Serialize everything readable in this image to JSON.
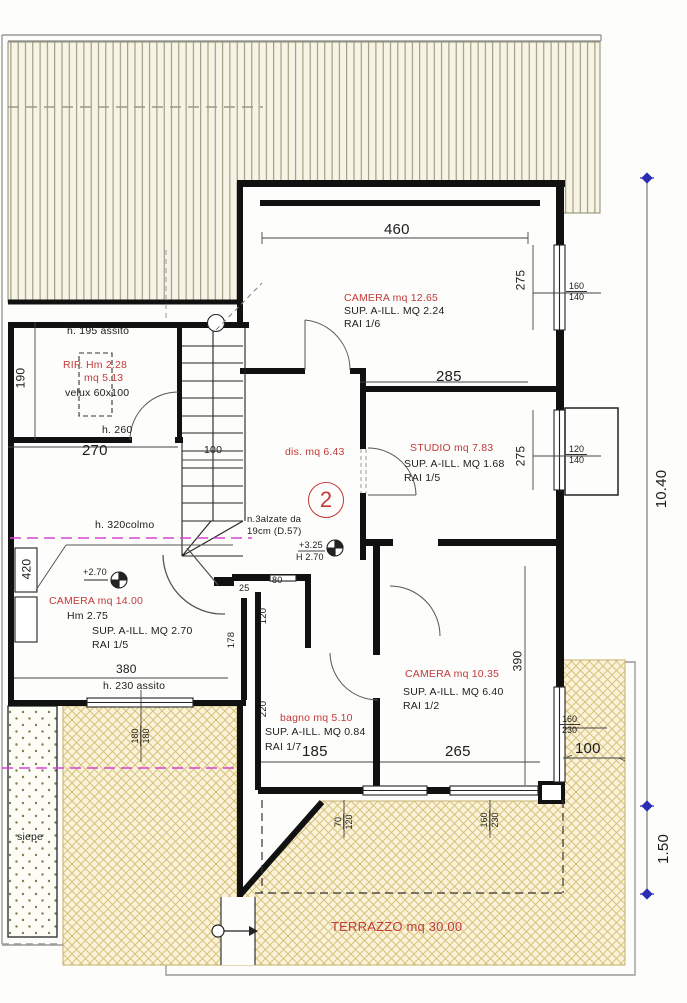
{
  "sheet": {
    "floor_badge": "2"
  },
  "colors": {
    "accent_red": "#c23a3a",
    "magenta": "#d544d5",
    "dim_marker_blue": "#2b2bb5",
    "roof_line": "#8f8f72",
    "terrace_line": "#d9c27c"
  },
  "rooms": [
    {
      "id": "camera-nord",
      "name": "CAMERA mq 12.65",
      "sup": "SUP. A-ILL. MQ 2.24",
      "rai": "RAI 1/6"
    },
    {
      "id": "rip",
      "name": "RIP. Hm 2.28",
      "name2": "mq 5.13",
      "velux": "velux 60x100",
      "h_top": "h. 195 assito",
      "h_door": "h. 260"
    },
    {
      "id": "disimpegno",
      "name": "dis. mq 6.43"
    },
    {
      "id": "studio",
      "name": "STUDIO mq 7.83",
      "sup": "SUP. A-ILL. MQ 1.68",
      "rai": "RAI 1/5"
    },
    {
      "id": "camera-ovest",
      "name": "CAMERA mq 14.00",
      "hm": "Hm 2.75",
      "sup": "SUP. A-ILL. MQ 2.70",
      "rai": "RAI 1/5",
      "h_colmo": "h. 320colmo",
      "h_assito": "h. 230 assito"
    },
    {
      "id": "bagno",
      "name": "bagno mq 5.10",
      "sup": "SUP. A-ILL. MQ 0.84",
      "rai": "RAI 1/7"
    },
    {
      "id": "camera-sud",
      "name": "CAMERA mq 10.35",
      "sup": "SUP. A-ILL. MQ 6.40",
      "rai": "RAI 1/2"
    },
    {
      "id": "terrazzo",
      "name": "TERRAZZO mq 30.00"
    },
    {
      "id": "siepe",
      "name": "siepe"
    }
  ],
  "stairs": {
    "note1": "n.3alzate da",
    "note2": "19cm (D.57)",
    "width": "100"
  },
  "levels": {
    "plus270": "+2.70",
    "plus325": "+3.25",
    "h270": "H 2.70"
  },
  "dims": {
    "d460": "460",
    "d285": "285",
    "d270": "270",
    "d380": "380",
    "d185": "185",
    "d265": "265",
    "d100_terrace": "100",
    "d100_stairs": "100",
    "d190": "190",
    "d420": "420",
    "d275a": "275",
    "d275b": "275",
    "d390": "390",
    "d178": "178",
    "d220": "220",
    "d120_bagno": "120",
    "d80": "80",
    "d25": "25",
    "w160a": "160",
    "w140a": "140",
    "w120a": "120",
    "w140b": "140",
    "w160b": "160",
    "w230a": "230",
    "w70": "70",
    "w120b": "120",
    "w160c": "160",
    "w230b": "230",
    "d180a": "180",
    "d180b": "180",
    "total_height": "10.40",
    "total_balcony": "1.50"
  }
}
